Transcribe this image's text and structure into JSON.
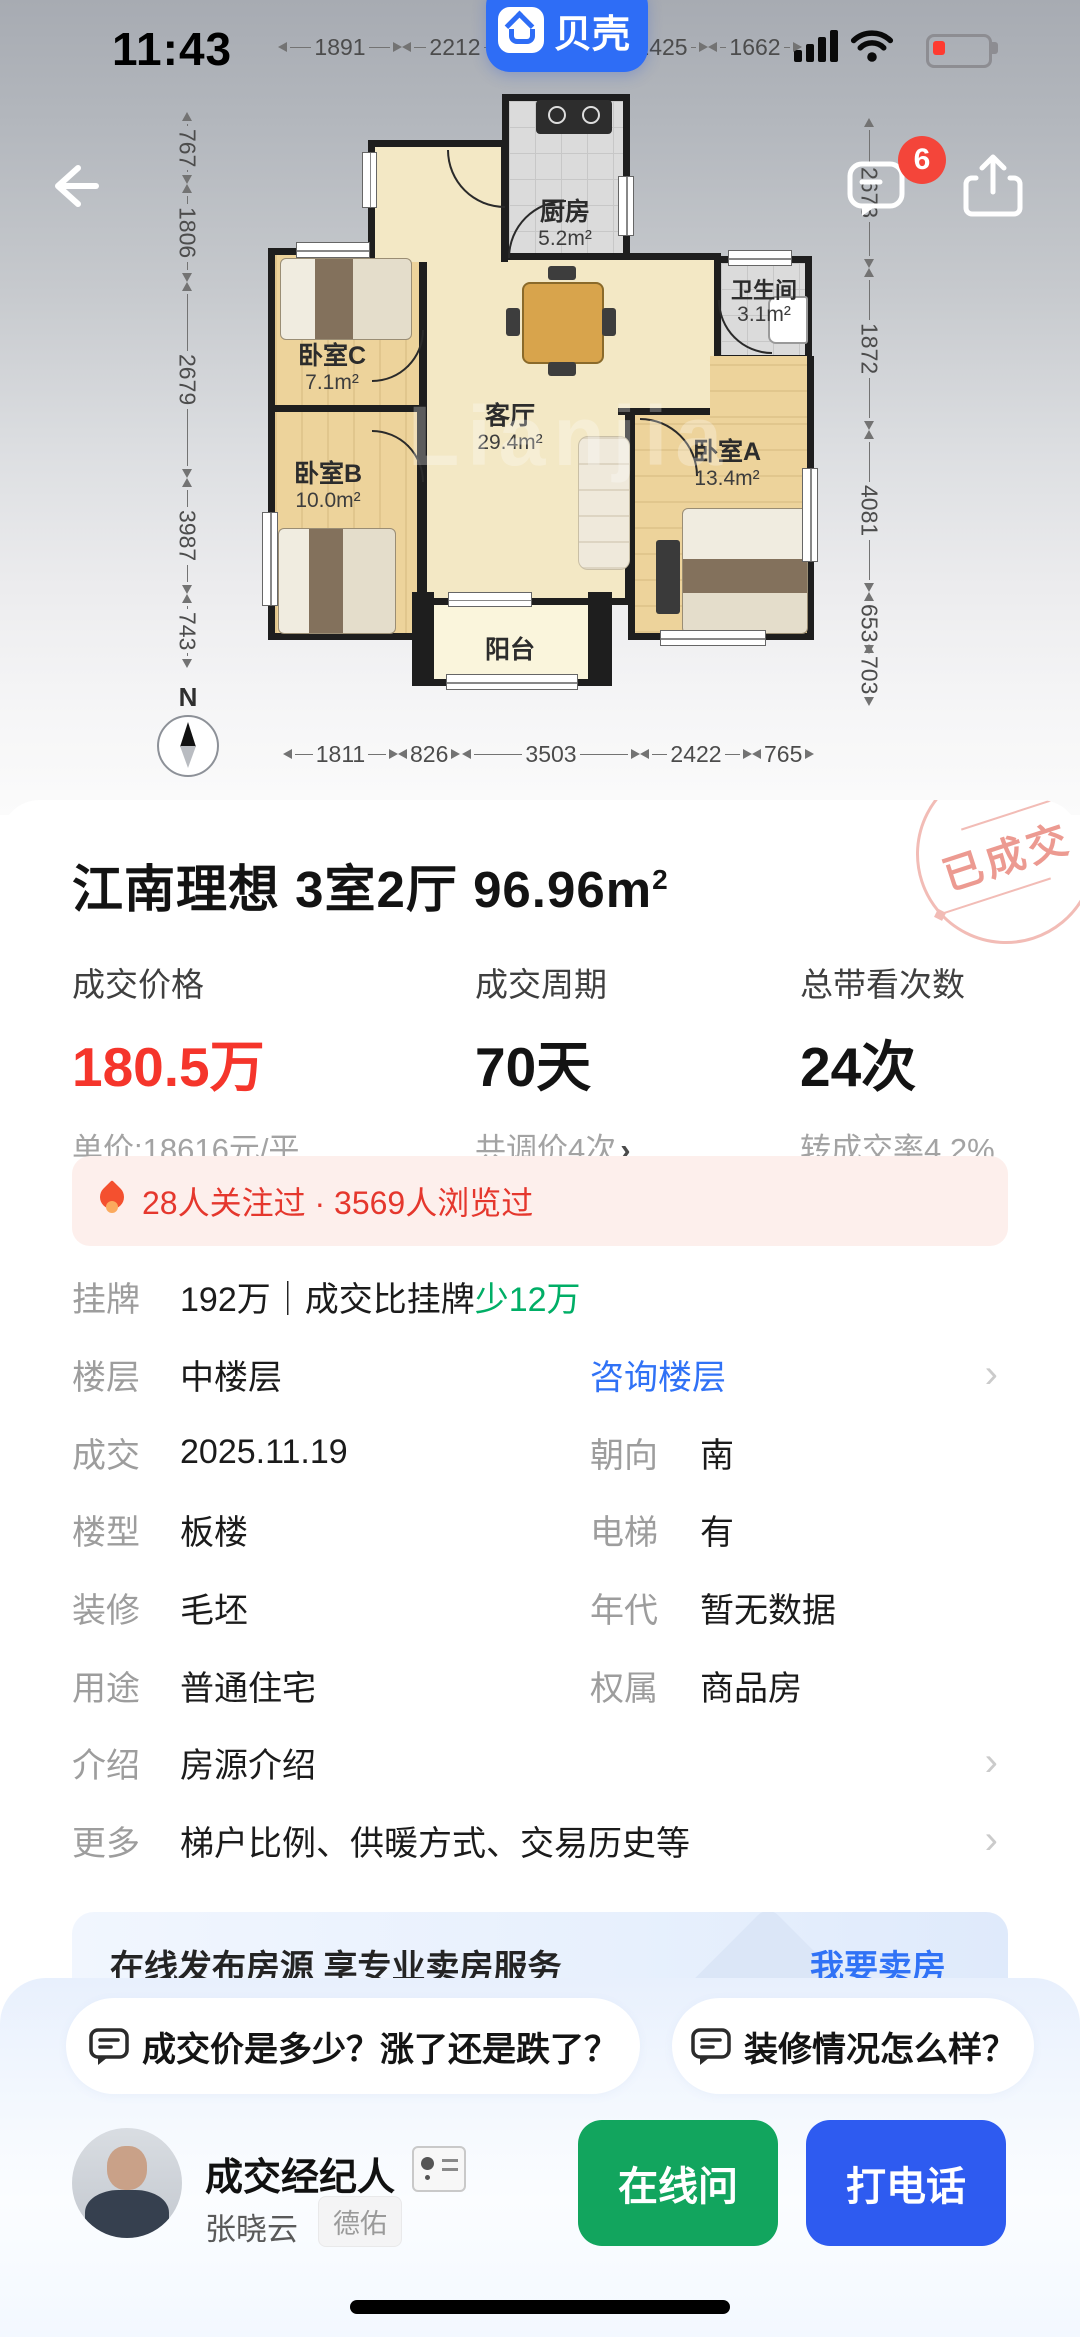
{
  "status_bar": {
    "time": "11:43"
  },
  "app_pill": {
    "label": "贝壳"
  },
  "nav": {
    "badge_count": "6"
  },
  "floorplan": {
    "watermark": "Lianjia",
    "compass": "N",
    "rooms": {
      "kitchen": {
        "name": "厨房",
        "area": "5.2m²"
      },
      "bath": {
        "name": "卫生间",
        "area": "3.1m²"
      },
      "bedA": {
        "name": "卧室A",
        "area": "13.4m²"
      },
      "bedB": {
        "name": "卧室B",
        "area": "10.0m²"
      },
      "bedC": {
        "name": "卧室C",
        "area": "7.1m²"
      },
      "living": {
        "name": "客厅",
        "area": "29.4m²"
      },
      "balcony": {
        "name": "阳台",
        "area": ""
      }
    },
    "dims": {
      "top": [
        "1891",
        "2212",
        "1425",
        "1662"
      ],
      "left": [
        "767",
        "1806",
        "2679",
        "3987",
        "743"
      ],
      "right": [
        "2673",
        "1872",
        "4081",
        "653",
        "703"
      ],
      "bottom": [
        "1811",
        "826",
        "3503",
        "2422",
        "765"
      ]
    }
  },
  "listing": {
    "stamp": "已成交",
    "title": "江南理想 3室2厅 96.96",
    "title_unit": "m",
    "title_sup": "2",
    "stats": [
      {
        "label": "成交价格",
        "value": "180.5万",
        "sub": "单价:18616元/平"
      },
      {
        "label": "成交周期",
        "value": "70天",
        "sub": "共调价4次",
        "sub_chevron": "›"
      },
      {
        "label": "总带看次数",
        "value": "24次",
        "sub": "转成交率4.2%"
      }
    ],
    "hot": "28人关注过 · 3569人浏览过"
  },
  "details": {
    "rows": [
      {
        "label": "挂牌",
        "value": "192万｜成交比挂牌",
        "highlight": "少12万"
      },
      {
        "label": "楼层",
        "value": "中楼层",
        "link": "咨询楼层"
      },
      {
        "label": "成交",
        "value": "2025.11.19",
        "label2": "朝向",
        "value2": "南"
      },
      {
        "label": "楼型",
        "value": "板楼",
        "label2": "电梯",
        "value2": "有"
      },
      {
        "label": "装修",
        "value": "毛坯",
        "label2": "年代",
        "value2": "暂无数据"
      },
      {
        "label": "用途",
        "value": "普通住宅",
        "label2": "权属",
        "value2": "商品房"
      },
      {
        "label": "介绍",
        "value": "房源介绍"
      },
      {
        "label": "更多",
        "value": "梯户比例、供暖方式、交易历史等"
      }
    ]
  },
  "sell_banner": {
    "text": "在线发布房源 享专业卖房服务",
    "link": "我要卖房"
  },
  "sheet": {
    "questions": [
      {
        "text": "成交价是多少？涨了还是跌了？"
      },
      {
        "text": "装修情况怎么样？"
      }
    ],
    "agent": {
      "role": "成交经纪人",
      "name": "张晓云",
      "brand": "德佑"
    },
    "buttons": {
      "chat": "在线问",
      "call": "打电话"
    }
  },
  "colors": {
    "accent_blue": "#3072F6",
    "green_text": "#00AE66",
    "price_red": "#F5352B",
    "btn_green": "#12A55E",
    "btn_blue": "#2E5BF0",
    "stamp_pink": "#F2BCB6"
  }
}
